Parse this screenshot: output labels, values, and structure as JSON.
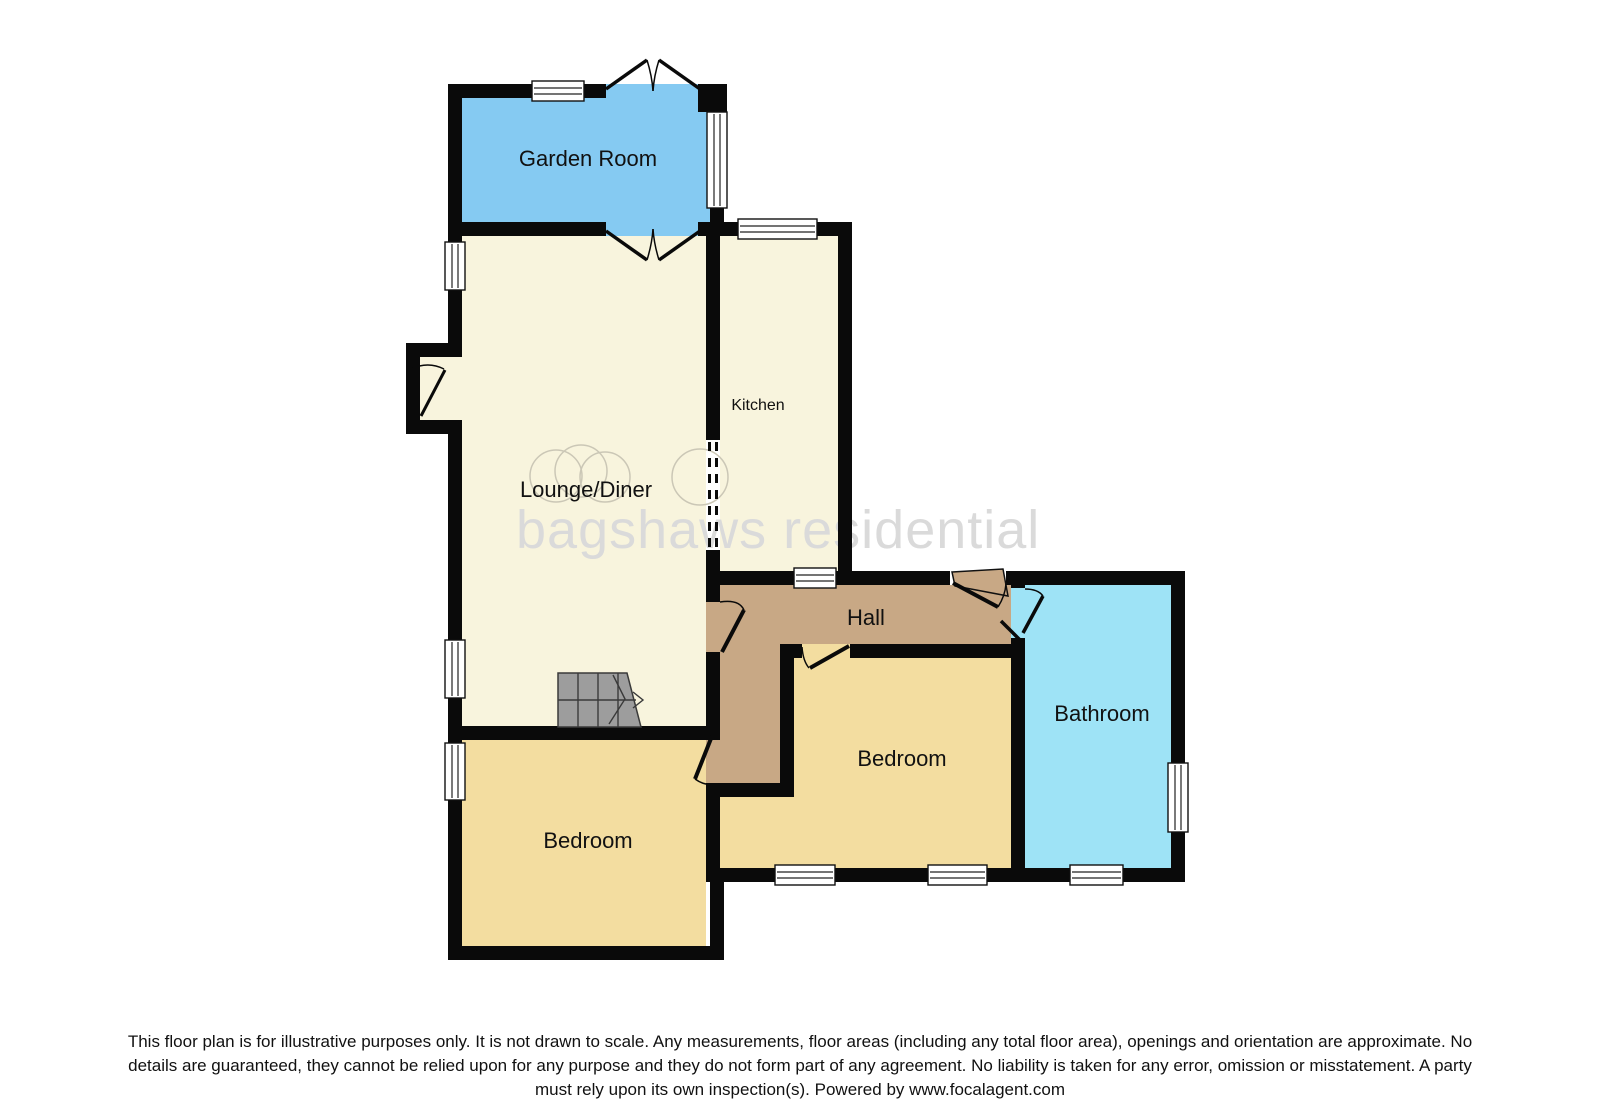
{
  "plan_title": "Ground floor plan",
  "rooms": {
    "garden_room": {
      "label": "Garden Room"
    },
    "lounge_diner": {
      "label": "Lounge/Diner"
    },
    "kitchen": {
      "label": "Kitchen"
    },
    "hall": {
      "label": "Hall"
    },
    "bedroom_right": {
      "label": "Bedroom"
    },
    "bathroom": {
      "label": "Bathroom"
    },
    "bedroom_left": {
      "label": "Bedroom"
    }
  },
  "watermark": "bagshaws residential",
  "colors": {
    "garden_room": "#85CAF2",
    "lounge": "#F8F4DD",
    "kitchen": "#F8F4DD",
    "hall": "#C8A885",
    "bedroom": "#F3DDA0",
    "bathroom": "#9EE3F6",
    "stairs": "#9D9D9D",
    "wall": "#0A0A0A",
    "watermark": "#DADADA",
    "garden_label": "#1C2B4E"
  },
  "disclaimer": {
    "lines": [
      "This floor plan is for illustrative purposes only. It is not drawn to scale. Any measurements, floor areas (including any total floor area), openings and orientation are approximate. No",
      "details are guaranteed, they cannot be relied upon for any purpose and they do not form part of any agreement. No liability is taken for any error, omission or misstatement. A party",
      "must rely upon its own inspection(s). Powered by www.focalagent.com"
    ]
  }
}
